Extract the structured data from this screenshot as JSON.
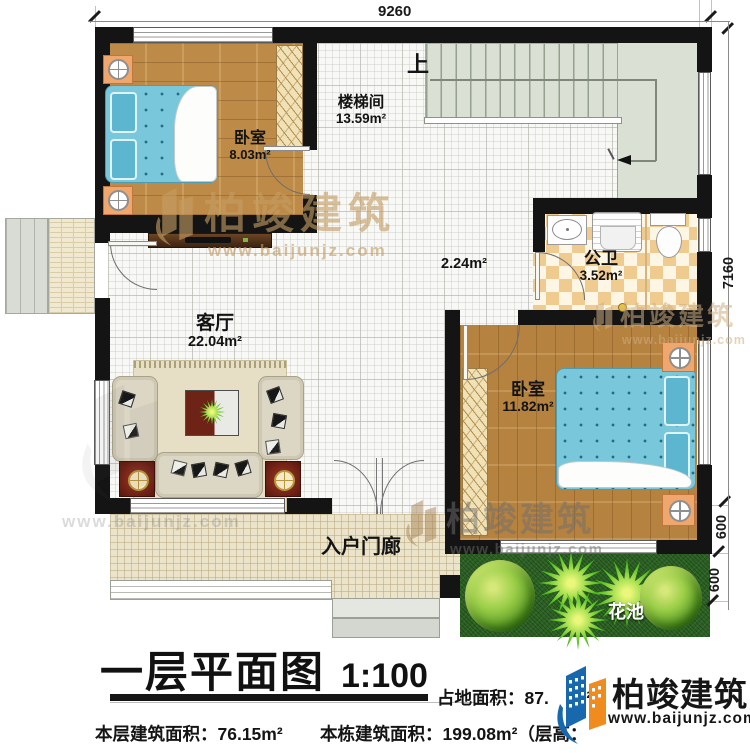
{
  "dims": {
    "top": "9260",
    "right": "7160",
    "seg_a": "600",
    "seg_b": "600"
  },
  "rooms": {
    "bedroom1": {
      "label": "卧室",
      "area": "8.03m²"
    },
    "stairwell": {
      "label": "楼梯间",
      "area": "13.59m²",
      "up": "上"
    },
    "hall": {
      "area": "2.24m²"
    },
    "bathroom": {
      "label": "公卫",
      "area": "3.52m²"
    },
    "living": {
      "label": "客厅",
      "area": "22.04m²"
    },
    "bedroom2": {
      "label": "卧室",
      "area": "11.82m²"
    },
    "porch": {
      "label": "入户门廊"
    },
    "flowerbed": {
      "label": "花池"
    }
  },
  "watermark": {
    "brand": "柏竣建筑",
    "url": "www.baijunjz.com"
  },
  "footer": {
    "title": "一层平面图",
    "scale": "1:100",
    "site_label": "占地面积：",
    "site_value": "87.",
    "site_unit": "m²",
    "floor_label": "本层建筑面积：",
    "floor_value": "76.15m²",
    "building_label": "本栋建筑面积：",
    "building_value": "199.08m²",
    "height_fragment": "（层高：",
    "logo_brand": "柏竣建筑",
    "logo_url": "www.baijunjz.com"
  },
  "colors": {
    "brand_blue": "#1768ad",
    "brand_orange": "#f08c1e",
    "wall": "#141414"
  }
}
